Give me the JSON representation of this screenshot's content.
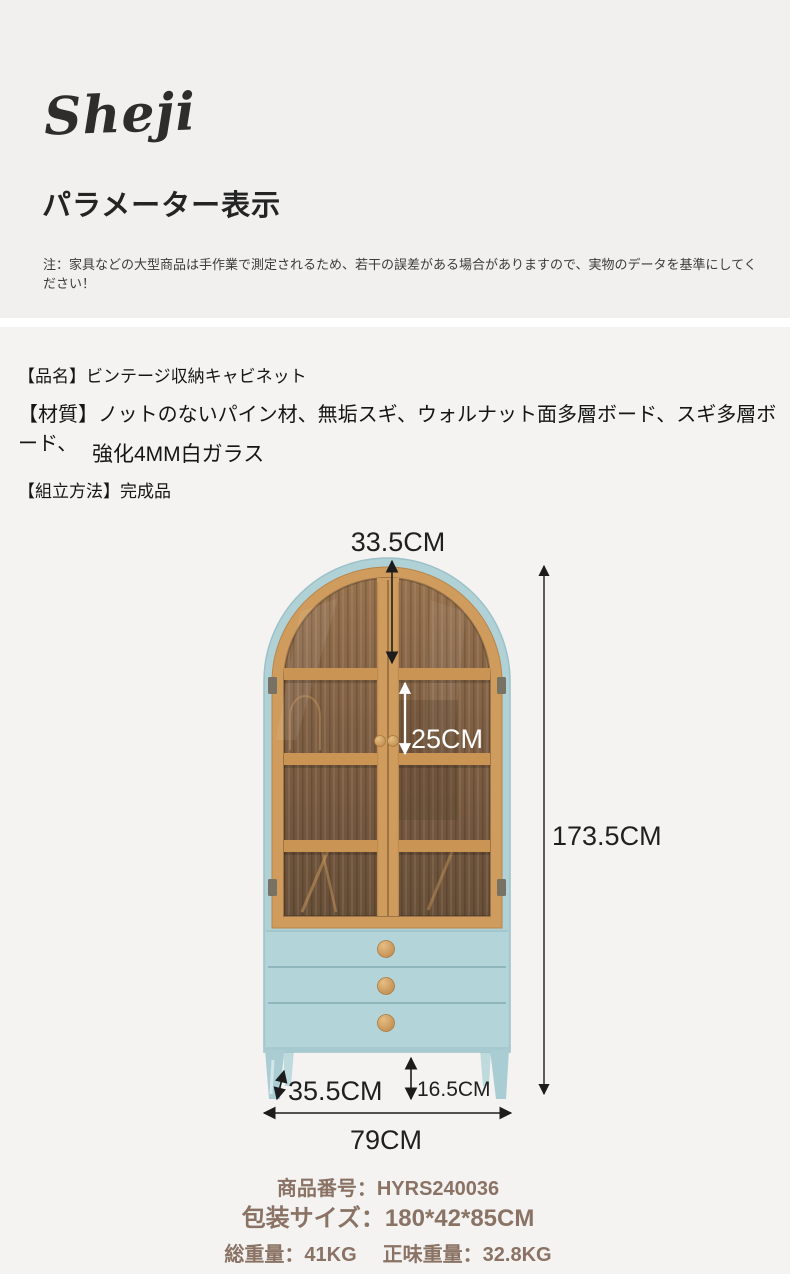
{
  "header": {
    "logo": "Sheji",
    "title": "パラメーター表示",
    "note": "注：家具などの大型商品は手作業で測定されるため、若干の誤差がある場合がありますので、実物のデータを基準にしてください！"
  },
  "product": {
    "name_line": "【品名】ビンテージ収納キャビネット",
    "material_line": "【材質】ノットのないパイン材、無垢スギ、ウォルナット面多層ボード、スギ多層ボード、",
    "material_line2": "強化4MM白ガラス",
    "assembly_line": "【組立方法】完成品"
  },
  "dimensions": {
    "top_arch_depth": "33.5CM",
    "shelf_gap": "25CM",
    "height": "173.5CM",
    "depth": "35.5CM",
    "leg_height": "16.5CM",
    "width": "79CM"
  },
  "info": {
    "item_number": "商品番号：HYRS240036",
    "package_size": "包装サイズ：180*42*85CM",
    "gross_weight": "総重量：41KG",
    "net_weight": "正味重量：32.8KG"
  },
  "colors": {
    "page_background": "#f4f3f2",
    "header_background": "#f1f0ef",
    "cabinet_blue": "#b0d2d7",
    "wood_frame": "#cf9c5e",
    "glass_brown": "#7c5d41",
    "dimension_text": "#1f1f1f",
    "info_text": "#8a7365"
  }
}
